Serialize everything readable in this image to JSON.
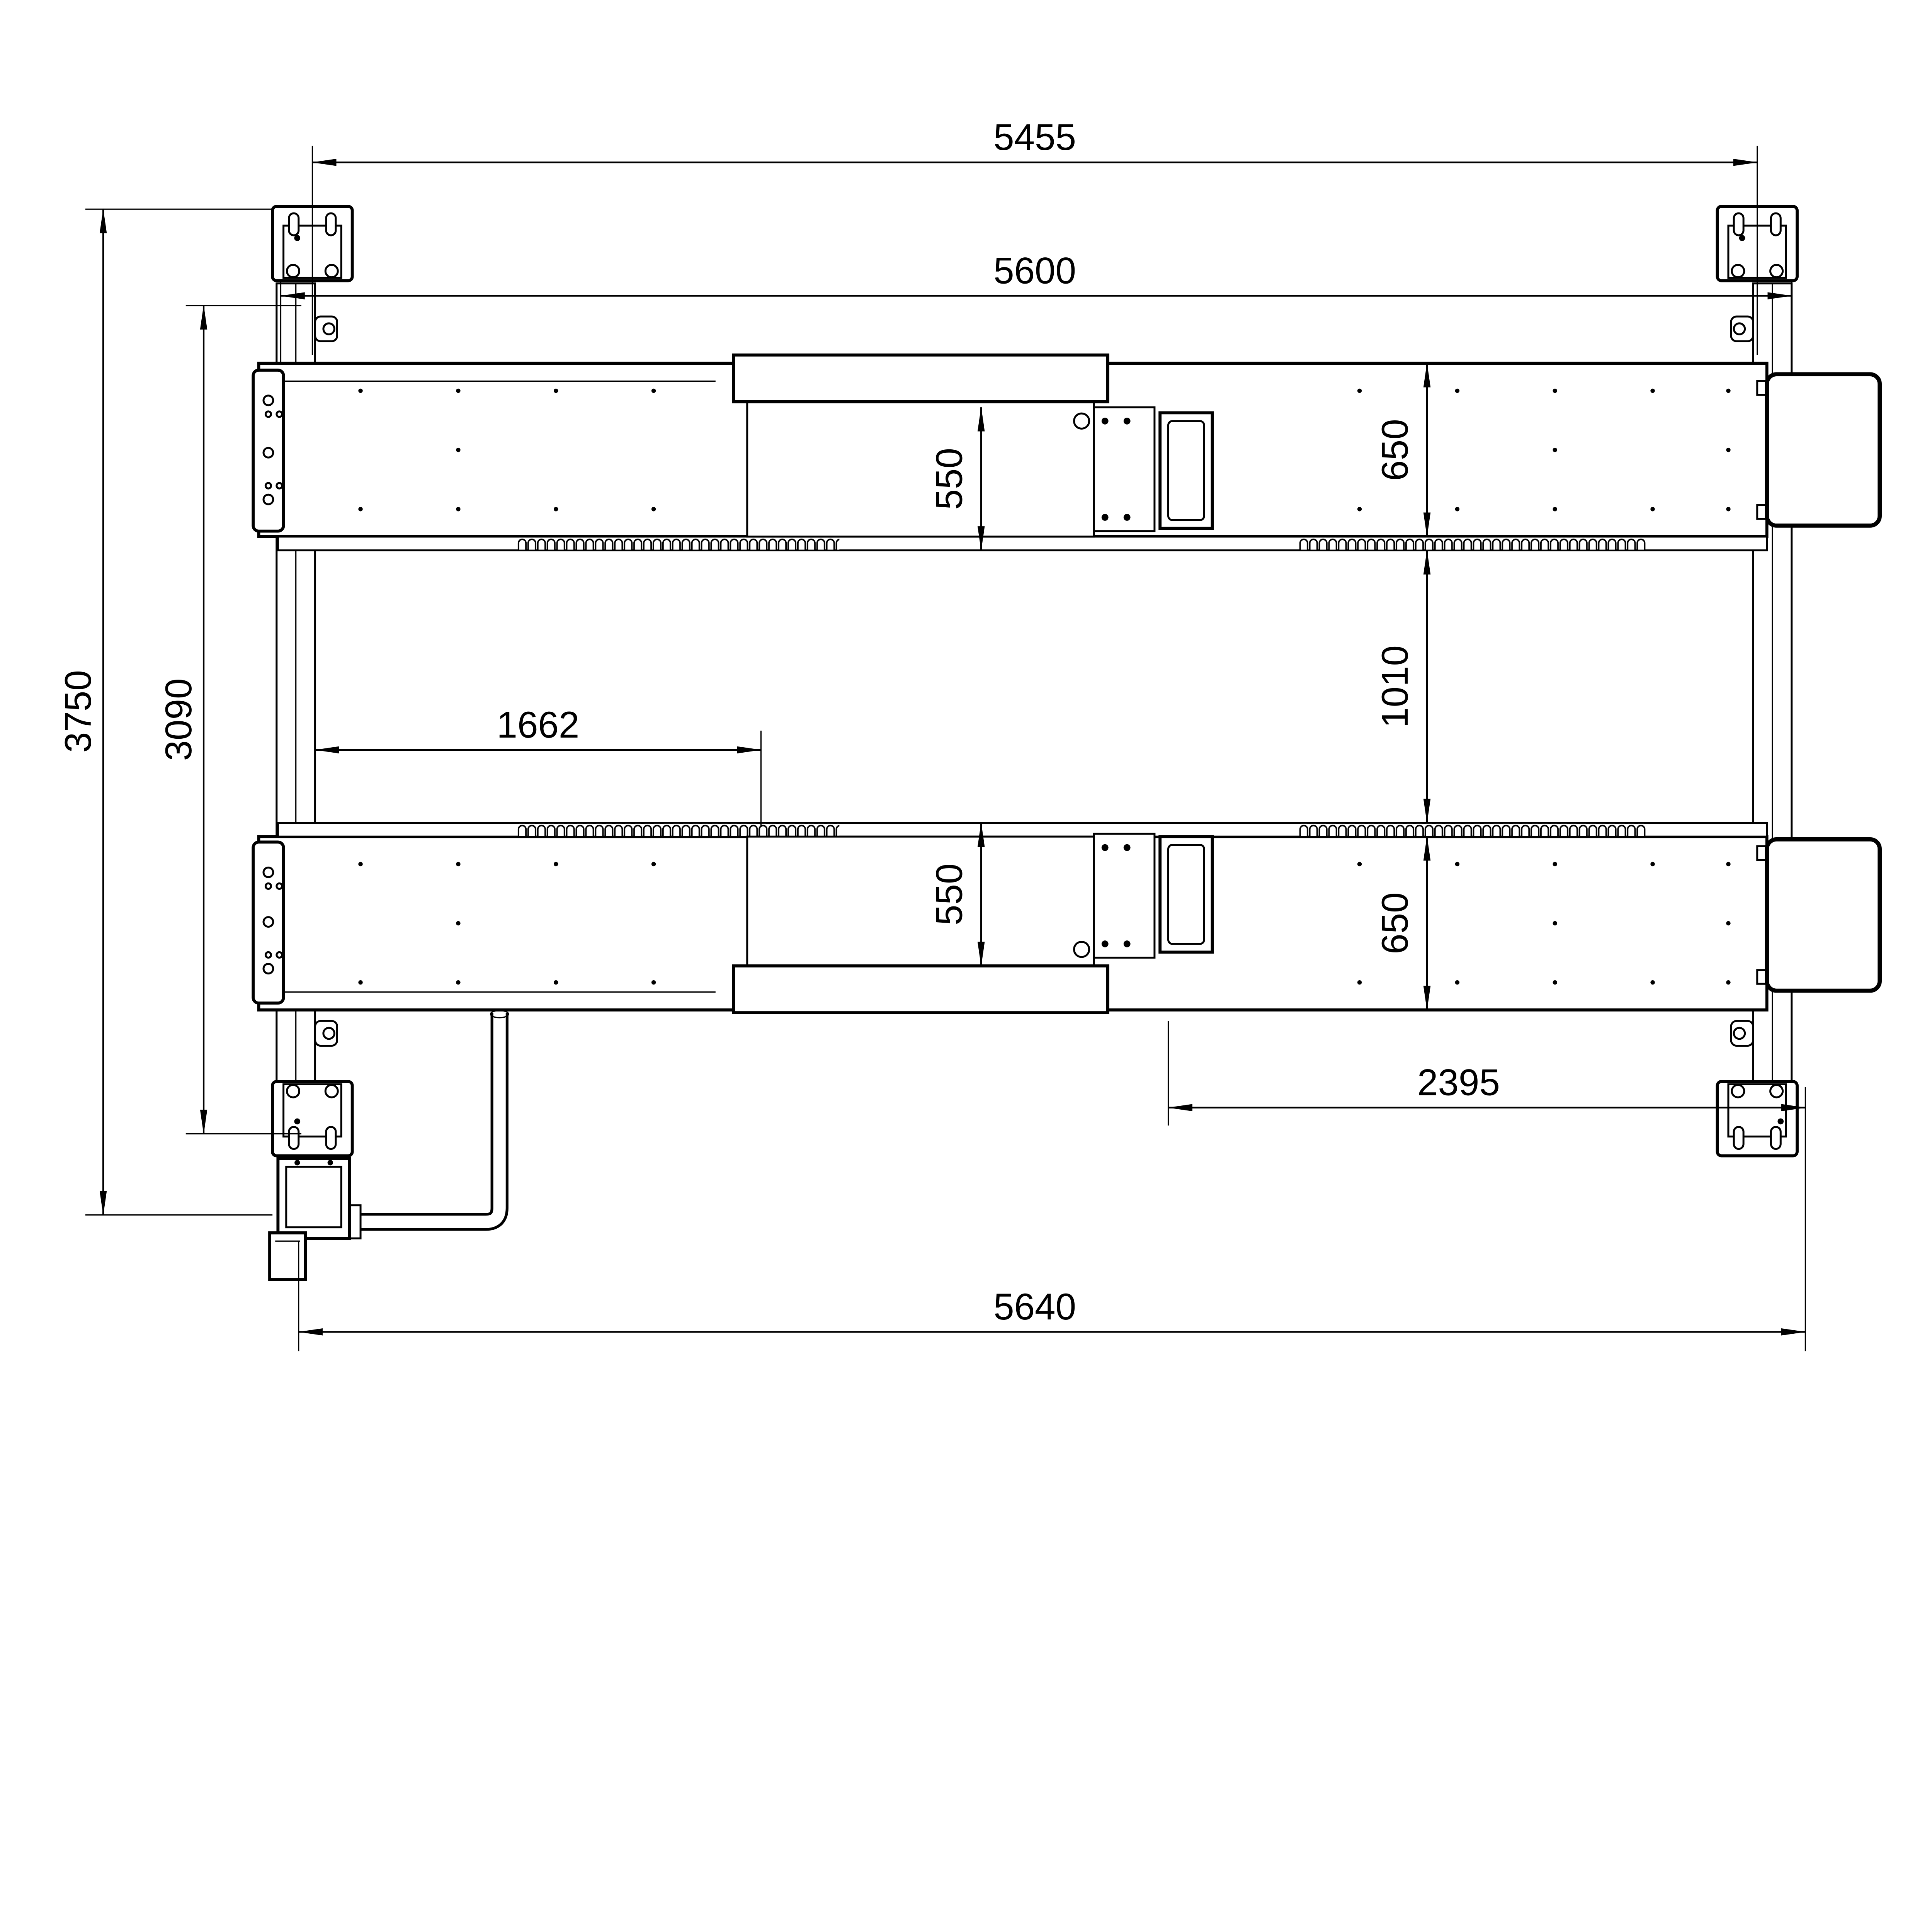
{
  "drawing": {
    "background": "#ffffff",
    "line_color": "#000000",
    "dims": {
      "span_post_centers": "5455",
      "span_columns": "5600",
      "depth_overall": "3750",
      "depth_inner": "3090",
      "tray_offset": "1662",
      "tray_width_top": "550",
      "runway_width_top": "650",
      "runway_gap": "1010",
      "tray_width_bottom": "550",
      "runway_width_bottom": "650",
      "tray_to_plate": "2395",
      "span_base_plates": "5640"
    }
  }
}
